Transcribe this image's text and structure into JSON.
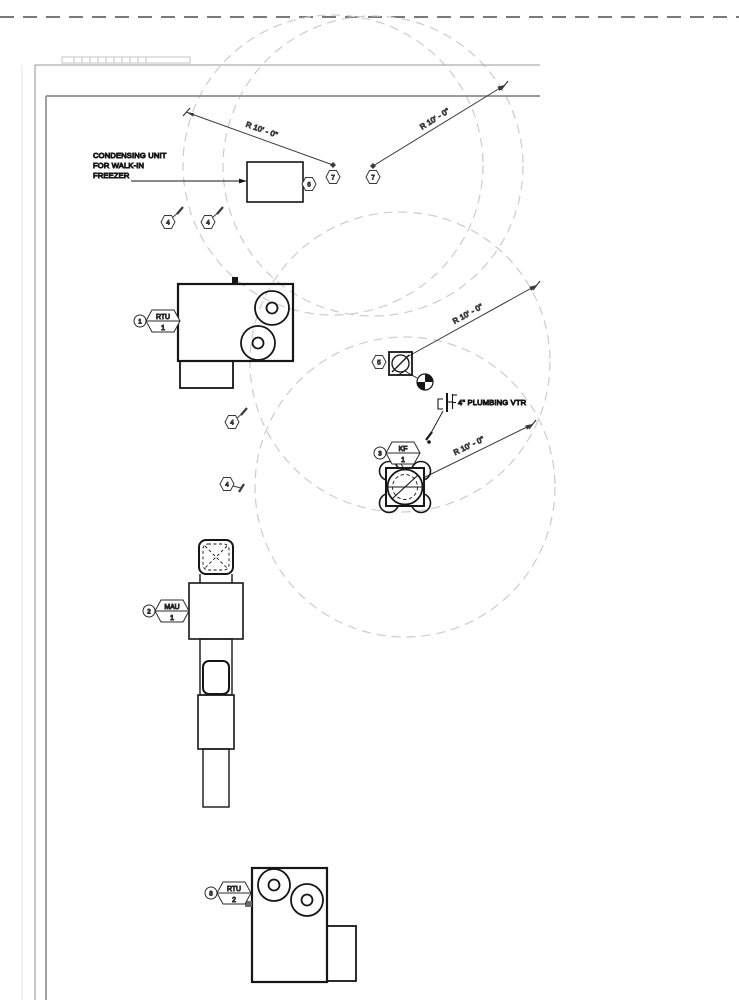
{
  "notes": {
    "condensing_unit": [
      "CONDENSING UNIT",
      "FOR WALK-IN",
      "FREEZER"
    ],
    "plumbing_vtr": "4\" PLUMBING VTR"
  },
  "dims": {
    "radius_label": "R 10' - 0\""
  },
  "equipment_tags": {
    "rtu1": {
      "ref": "1",
      "system": "RTU",
      "unit": "1"
    },
    "mau1": {
      "ref": "2",
      "system": "MAU",
      "unit": "1"
    },
    "kf1": {
      "ref": "3",
      "system": "KF",
      "unit": "1"
    },
    "rtu2": {
      "ref": "8",
      "system": "RTU",
      "unit": "2"
    }
  },
  "keynotes": {
    "n4": "4",
    "n5": "5",
    "n6": "6",
    "n7": "7"
  },
  "colors": {
    "equipment_line": "#161616",
    "dimension_line": "#3a3a3a",
    "building_line": "#9a9a9a",
    "clearance_dash": "#cccccc",
    "property_line": "#4d4d4d"
  }
}
